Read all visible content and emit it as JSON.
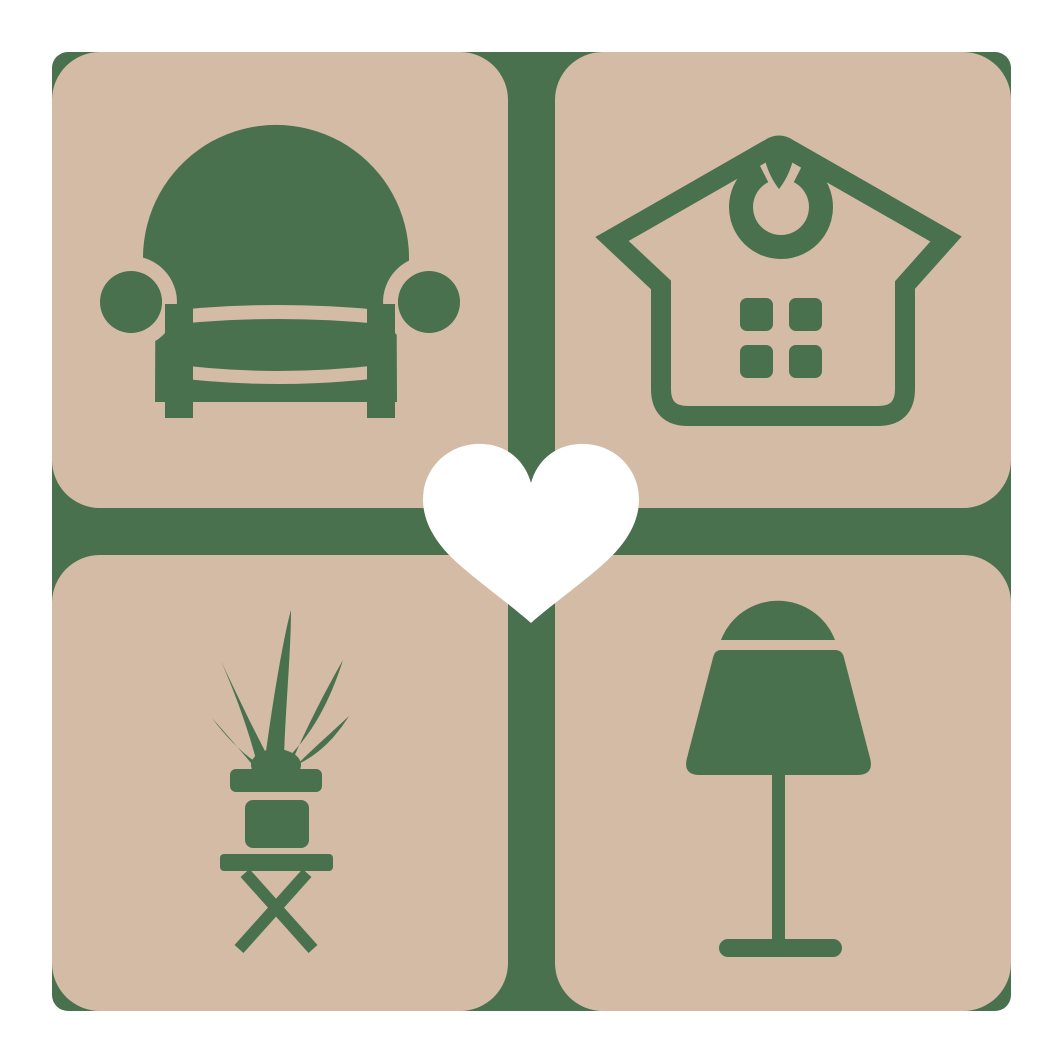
{
  "logo": {
    "name": "home-decor-furniture-logo",
    "colors": {
      "background": "#FFFFFF",
      "tile": "#D3BBA5",
      "green": "#49714E",
      "heart": "#FFFFFF"
    },
    "tiles": [
      {
        "position": "top-left",
        "icon": "armchair-icon",
        "label": "armchair"
      },
      {
        "position": "top-right",
        "icon": "house-icon",
        "label": "house with ornament"
      },
      {
        "position": "bottom-left",
        "icon": "potted-plant-icon",
        "label": "potted plant on stool"
      },
      {
        "position": "bottom-right",
        "icon": "table-lamp-icon",
        "label": "table lamp"
      }
    ],
    "center": {
      "icon": "heart-icon",
      "label": "heart"
    }
  }
}
